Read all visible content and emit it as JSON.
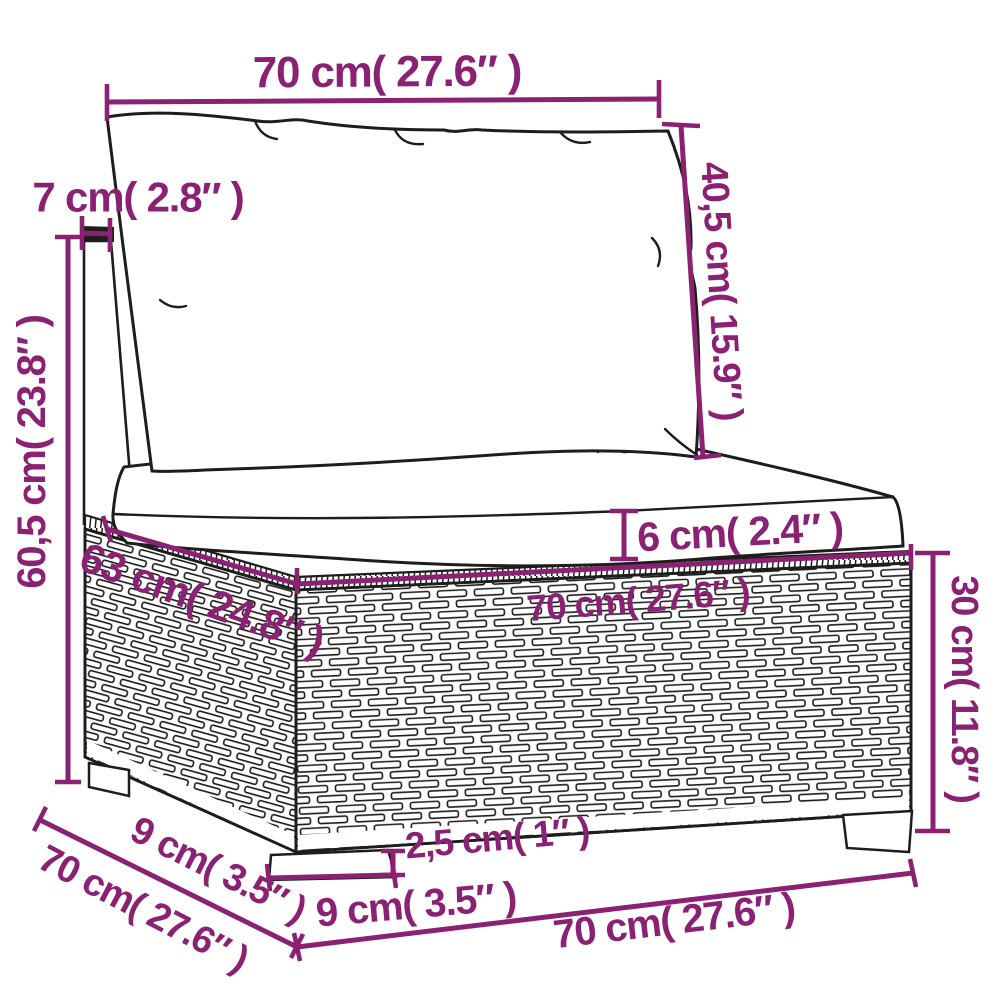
{
  "diagram": {
    "type": "furniture-dimension-drawing",
    "subject": "rattan-sofa-middle-section-with-cushions",
    "colors": {
      "annotation": "#8B2173",
      "line_art": "#1D1D1B",
      "background": "#FFFFFF"
    },
    "labels": {
      "top_width": "70 cm( 27.6″ )",
      "post_thickness": "7 cm( 2.8″ )",
      "back_cushion_height": "40,5 cm( 15.9″ )",
      "back_height": "60,5 cm( 23.8″ )",
      "seat_depth": "63 cm( 24.8″ )",
      "seat_width": "70 cm( 27.6″ )",
      "cushion_thickness": "6 cm( 2.4″ )",
      "base_height": "30 cm( 11.8″ )",
      "foot_height": "2,5 cm( 1″ )",
      "foot_width": "9 cm( 3.5″ )",
      "side_foot_depth": "9 cm( 3.5″ )",
      "side_depth": "70 cm( 27.6″ )",
      "bottom_width": "70 cm( 27.6″ )"
    }
  }
}
